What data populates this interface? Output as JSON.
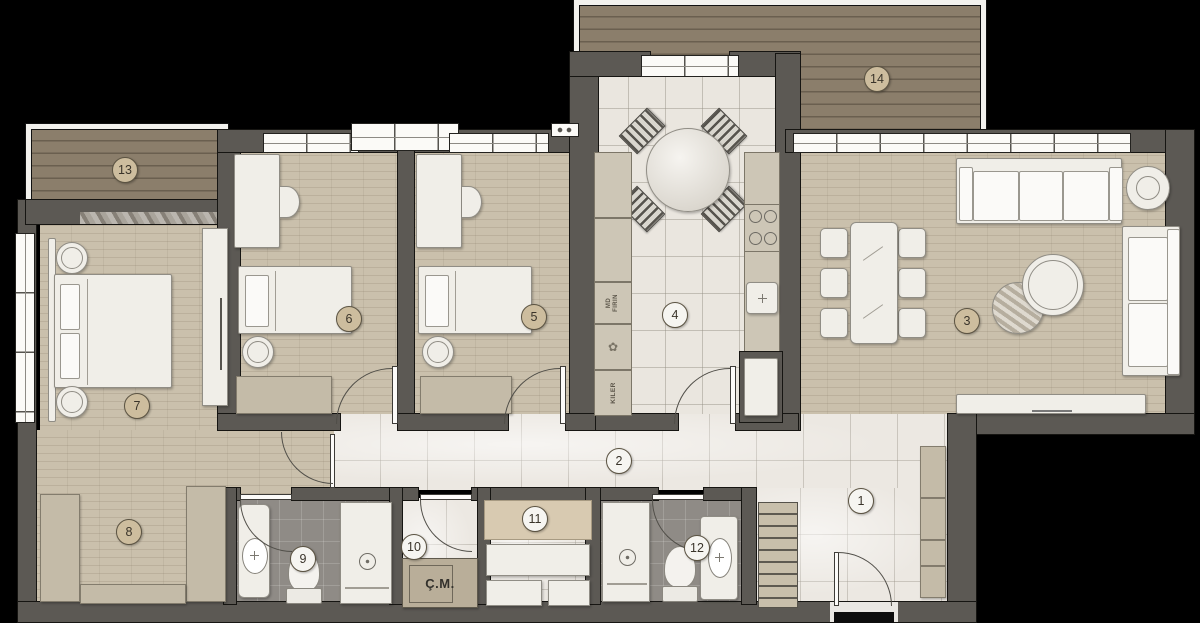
{
  "plan": {
    "room_markers": [
      {
        "label": "1"
      },
      {
        "label": "2"
      },
      {
        "label": "3"
      },
      {
        "label": "4"
      },
      {
        "label": "5"
      },
      {
        "label": "6"
      },
      {
        "label": "7"
      },
      {
        "label": "8"
      },
      {
        "label": "9"
      },
      {
        "label": "10"
      },
      {
        "label": "11"
      },
      {
        "label": "12"
      },
      {
        "label": "13"
      },
      {
        "label": "14"
      }
    ],
    "text_labels": {
      "washing_machine": "Ç.M.",
      "pantry": "KILER",
      "oven_line1": "MD",
      "oven_line2": "FIRIN"
    },
    "icons": {
      "flower": "✿"
    },
    "colors": {
      "background": "#000000",
      "wall": "#5c5954",
      "wood_deck": "#8b7e6b",
      "bedroom_floor": "#cac0ac",
      "tile_light": "#eae6df",
      "tile_dark": "#8f8b86",
      "furniture_white": "#f0eee8",
      "cabinet_beige": "#c4bba8",
      "marker_tan": "#cdbd9e",
      "marker_white": "#f6f5f1"
    }
  }
}
